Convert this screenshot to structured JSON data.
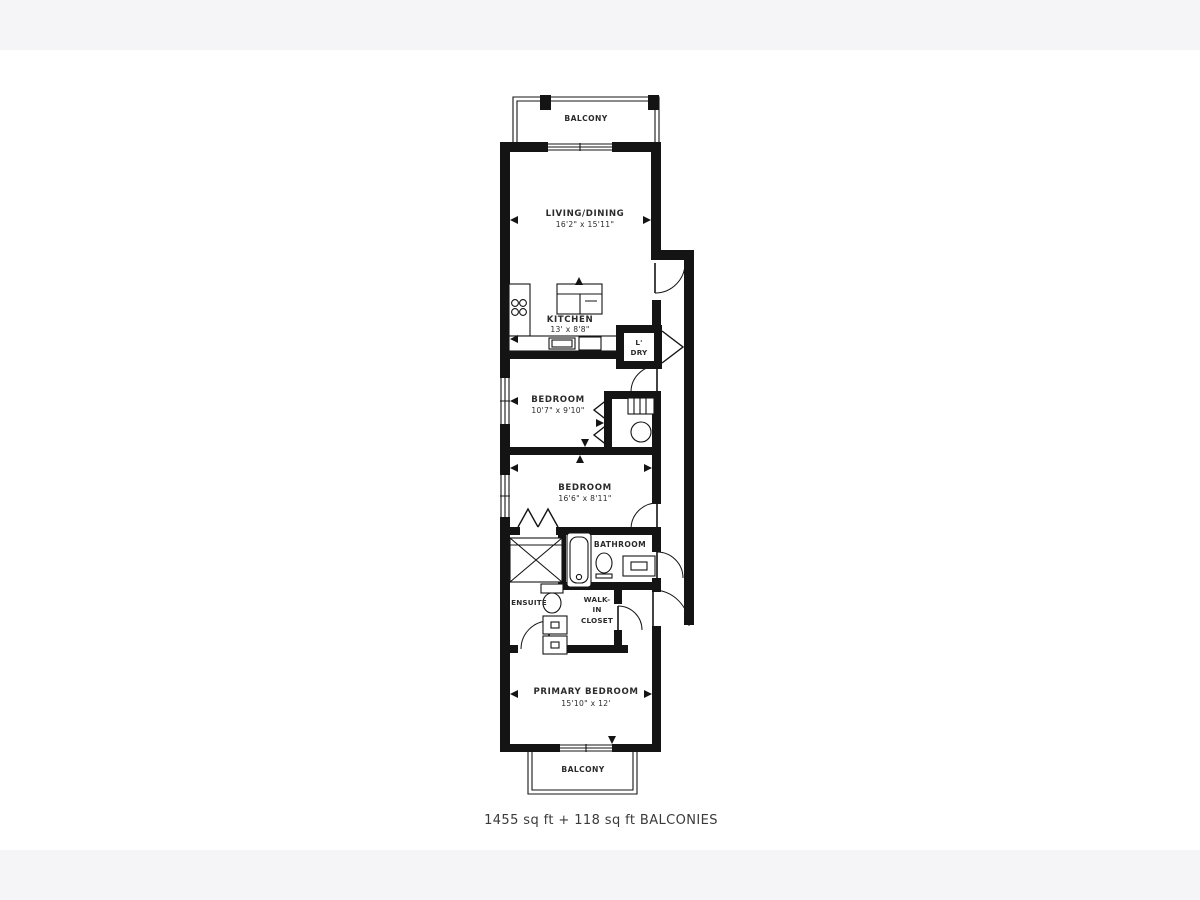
{
  "colors": {
    "wall": "#141414",
    "text": "#2b2b2b",
    "caption": "#3a3a3a",
    "band": "#f5f4f6"
  },
  "floorplan": {
    "caption": "1455 sq ft + 118 sq ft BALCONIES",
    "balcony_top": {
      "label": "BALCONY"
    },
    "balcony_bottom": {
      "label": "BALCONY"
    },
    "living_dining": {
      "label": "LIVING/DINING",
      "dims": "16'2\" x 15'11\""
    },
    "kitchen": {
      "label": "KITCHEN",
      "dims": "13' x 8'8\""
    },
    "laundry": {
      "line1": "L'",
      "line2": "DRY"
    },
    "bedroom1": {
      "label": "BEDROOM",
      "dims": "10'7\" x 9'10\""
    },
    "bedroom2": {
      "label": "BEDROOM",
      "dims": "16'6\" x 8'11\""
    },
    "bathroom": {
      "label": "BATHROOM"
    },
    "ensuite": {
      "label": "ENSUITE"
    },
    "walk_in_closet": {
      "line1": "WALK-",
      "line2": "IN",
      "line3": "CLOSET"
    },
    "primary_bedroom": {
      "label": "PRIMARY BEDROOM",
      "dims": "15'10\" x 12'"
    }
  }
}
